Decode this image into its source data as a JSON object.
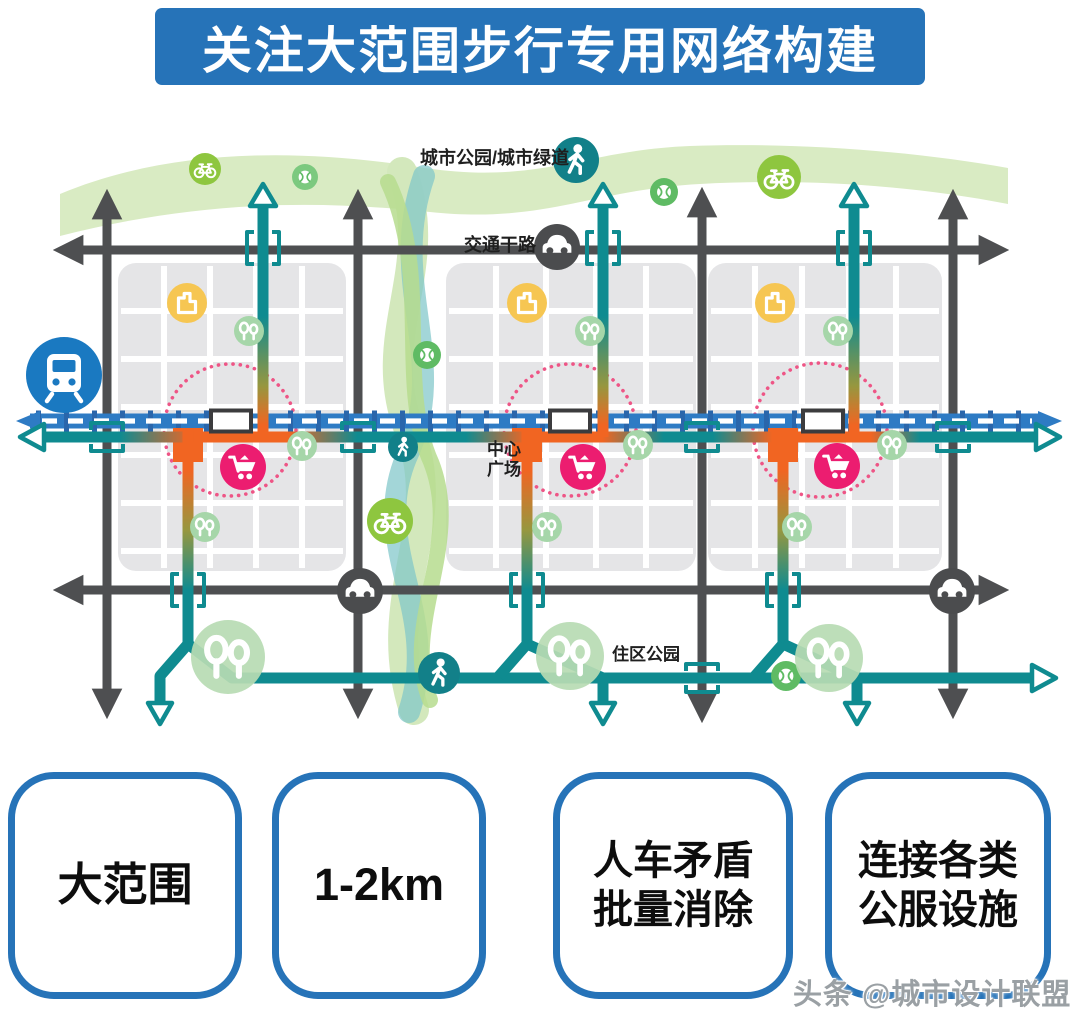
{
  "header": {
    "title": "关注大范围步行专用网络构建",
    "bg_color": "#2673b8"
  },
  "map": {
    "labels": {
      "greenway": "城市公园/城市绿道",
      "arterial_road": "交通干路",
      "central_plaza": [
        "中心",
        "广场"
      ],
      "residential_park": "住区公园"
    },
    "icons": [
      "train-icon",
      "pedestrian-icon",
      "bicycle-icon",
      "sports-ball-icon",
      "building-icon",
      "trees-icon",
      "shopping-cart-icon",
      "car-icon"
    ],
    "colors": {
      "pedestrian_teal": "#0f8b90",
      "rail_blue": "#2e7bc4",
      "plaza_orange": "#f16522",
      "commercial_magenta": "#ec1d70",
      "road_gray": "#4e4f51",
      "park_green": "#b7dbb3",
      "greenway_band": "#d9ebc3",
      "bike_green": "#8ec63f",
      "building_yellow": "#f6c652",
      "accent_blue": "#2673b8"
    }
  },
  "cards": [
    {
      "lines": [
        "大范围"
      ]
    },
    {
      "lines": [
        "1-2km"
      ]
    },
    {
      "lines": [
        "人车矛盾",
        "批量消除"
      ]
    },
    {
      "lines": [
        "连接各类",
        "公服设施"
      ]
    }
  ],
  "watermark": "头条 @城市设计联盟"
}
